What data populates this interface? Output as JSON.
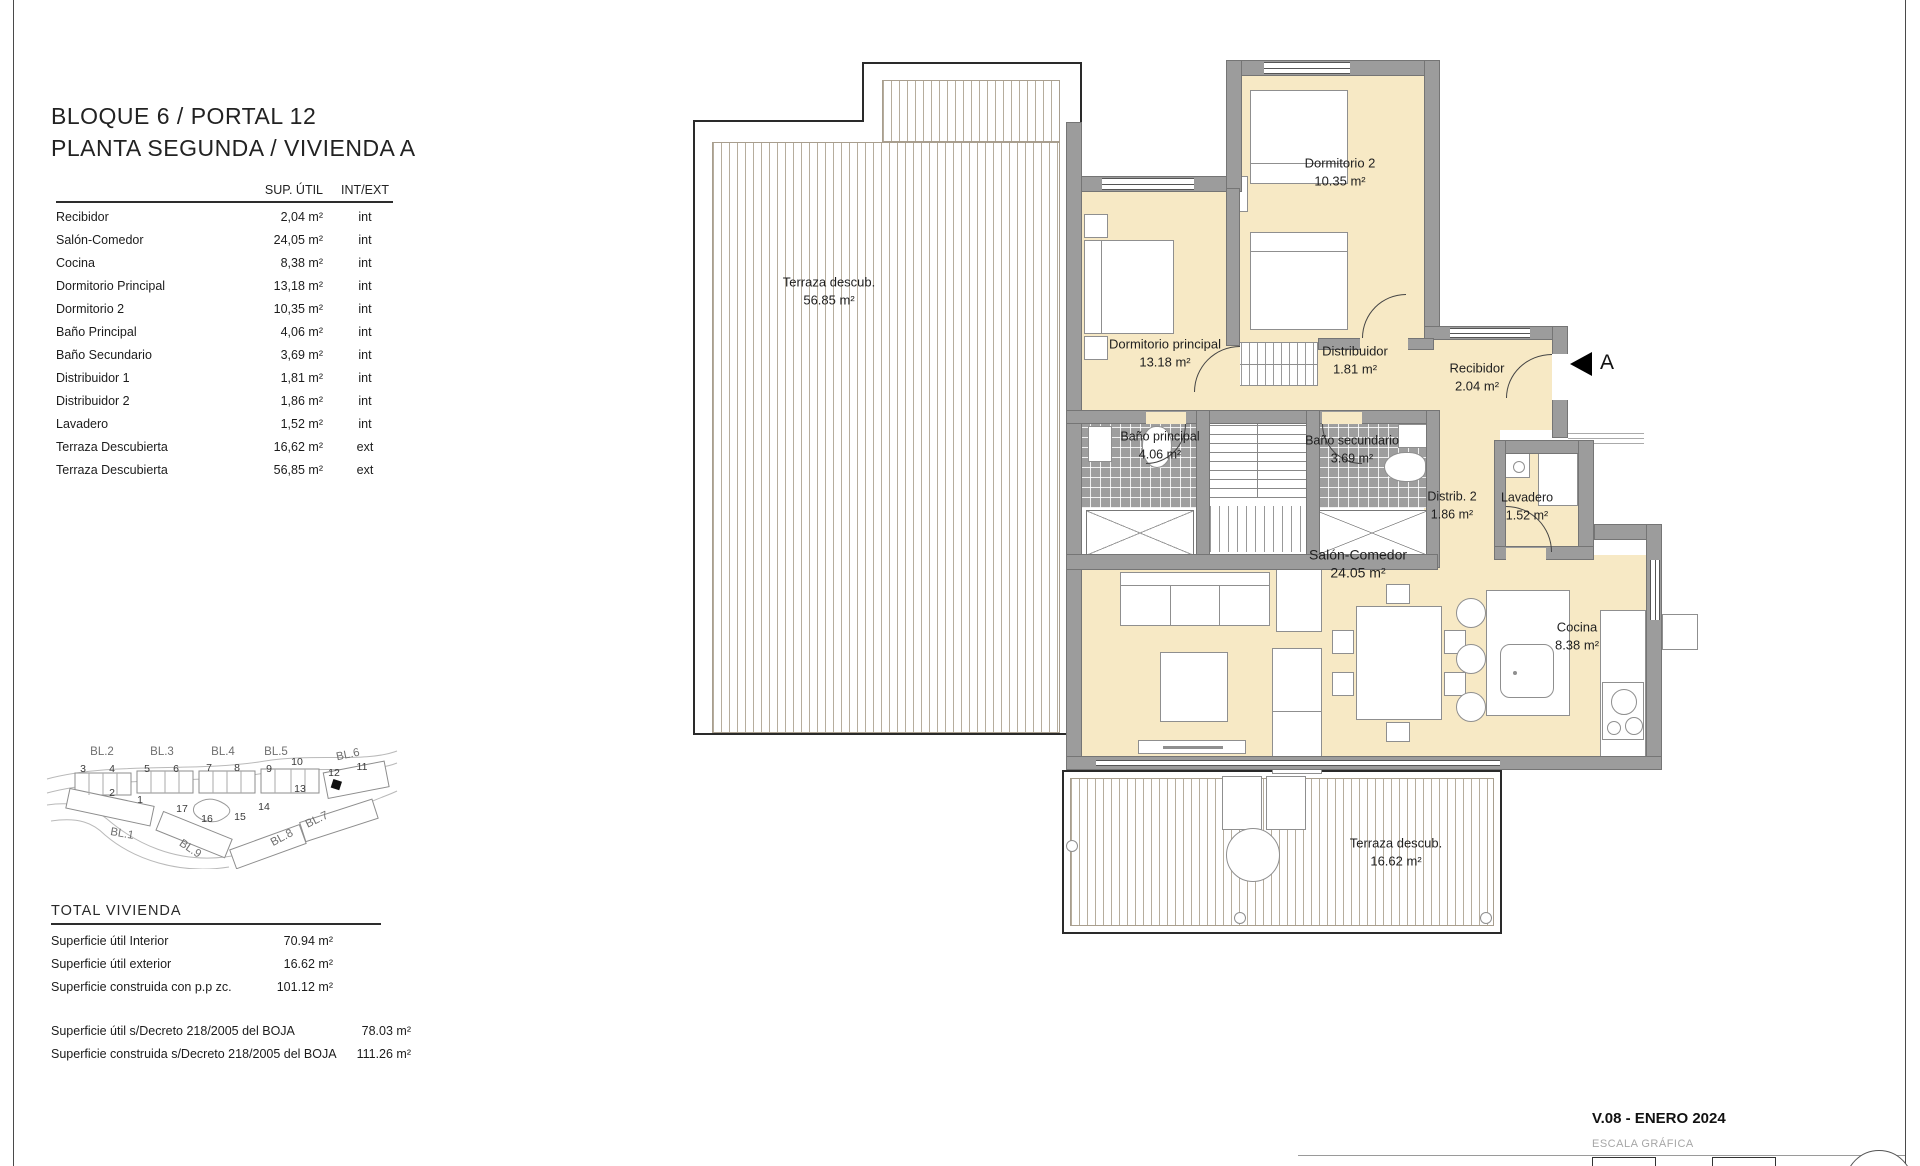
{
  "page": {
    "title_line1": "BLOQUE 6 / PORTAL 12",
    "title_line2": "PLANTA SEGUNDA / VIVIENDA A"
  },
  "surfaces_table": {
    "headers": {
      "col_area": "SUP. ÚTIL",
      "col_type": "INT/EXT"
    },
    "rows": [
      {
        "name": "Recibidor",
        "area": "2,04 m²",
        "type": "int"
      },
      {
        "name": "Salón-Comedor",
        "area": "24,05 m²",
        "type": "int"
      },
      {
        "name": "Cocina",
        "area": "8,38 m²",
        "type": "int"
      },
      {
        "name": "Dormitorio Principal",
        "area": "13,18 m²",
        "type": "int"
      },
      {
        "name": "Dormitorio 2",
        "area": "10,35 m²",
        "type": "int"
      },
      {
        "name": "Baño Principal",
        "area": "4,06 m²",
        "type": "int"
      },
      {
        "name": "Baño Secundario",
        "area": "3,69 m²",
        "type": "int"
      },
      {
        "name": "Distribuidor 1",
        "area": "1,81 m²",
        "type": "int"
      },
      {
        "name": "Distribuidor 2",
        "area": "1,86 m²",
        "type": "int"
      },
      {
        "name": "Lavadero",
        "area": "1,52 m²",
        "type": "int"
      },
      {
        "name": "Terraza Descubierta",
        "area": "16,62 m²",
        "type": "ext"
      },
      {
        "name": "Terraza Descubierta",
        "area": "56,85 m²",
        "type": "ext"
      }
    ]
  },
  "site_map": {
    "block_labels": [
      "BL.2",
      "BL.3",
      "BL.4",
      "BL.5",
      "BL.6",
      "BL.1",
      "BL.9",
      "BL.8",
      "BL.7"
    ],
    "portal_numbers": [
      "3",
      "4",
      "5",
      "6",
      "7",
      "8",
      "9",
      "10",
      "12",
      "11",
      "2",
      "1",
      "17",
      "16",
      "15",
      "14",
      "13"
    ],
    "highlighted_portal": "12"
  },
  "totals": {
    "heading": "TOTAL VIVIENDA",
    "rows": [
      {
        "label": "Superficie útil Interior",
        "value": "70.94 m²"
      },
      {
        "label": "Superficie útil exterior",
        "value": "16.62 m²"
      },
      {
        "label": "Superficie construida con p.p zc.",
        "value": "101.12 m²"
      }
    ],
    "boja_rows": [
      {
        "label": "Superficie útil s/Decreto 218/2005 del BOJA",
        "value": "78.03 m²"
      },
      {
        "label": "Superficie construida s/Decreto 218/2005 del BOJA",
        "value": "111.26 m²"
      }
    ]
  },
  "plan": {
    "rooms": [
      {
        "name": "Terraza descub.",
        "area": "56.85 m²"
      },
      {
        "name": "Dormitorio 2",
        "area": "10.35 m²"
      },
      {
        "name": "Dormitorio principal",
        "area": "13.18 m²"
      },
      {
        "name": "Distribuidor",
        "area": "1.81 m²"
      },
      {
        "name": "Recibidor",
        "area": "2.04 m²"
      },
      {
        "name": "Baño principal",
        "area": "4.06 m²"
      },
      {
        "name": "Baño secundario",
        "area": "3.69 m²"
      },
      {
        "name": "Distrib. 2",
        "area": "1.86 m²"
      },
      {
        "name": "Lavadero",
        "area": "1.52 m²"
      },
      {
        "name": "Salón-Comedor",
        "area": "24.05 m²"
      },
      {
        "name": "Cocina",
        "area": "8.38 m²"
      },
      {
        "name": "Terraza descub.",
        "area": "16.62 m²"
      }
    ],
    "section_marker": "A"
  },
  "footer": {
    "version": "V.08 - ENERO 2024",
    "scale_label": "ESCALA GRÁFICA"
  },
  "colors": {
    "room_fill": "#f7e9c5",
    "wall_gray": "#9c9c9c",
    "tile_gray": "#9e9e9e",
    "deck_line": "#b6ad9d",
    "marker_black": "#000000"
  }
}
